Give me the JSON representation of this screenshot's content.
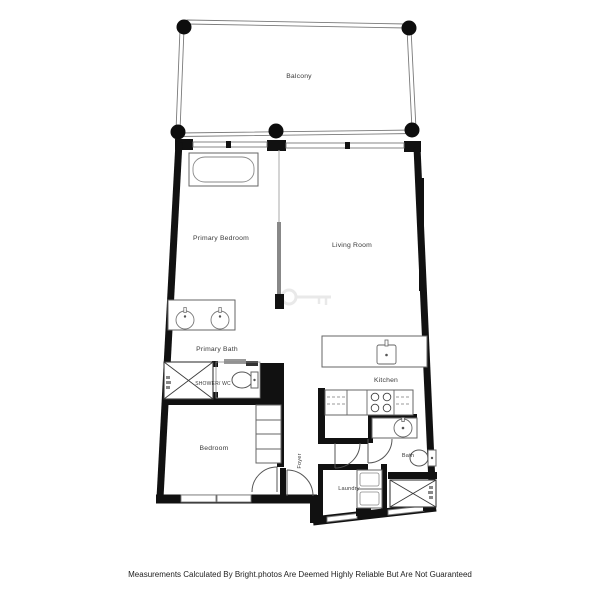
{
  "colors": {
    "background": "#ffffff",
    "wall": "#111111",
    "fixture_line": "#666666",
    "thin_line": "#7a7a7a",
    "label_text": "#3a3a3a",
    "footer_text": "#222222",
    "watermark": "#d8d8d8"
  },
  "rooms": {
    "balcony": "Balcony",
    "primary_bedroom": "Primary Bedroom",
    "living_room": "Living Room",
    "primary_bath": "Primary Bath",
    "shower_wc": "SHOWER/ WC",
    "bedroom": "Bedroom",
    "foyer": "Foyer",
    "kitchen": "Kitchen",
    "bath": "Bath",
    "laundry": "Laundry"
  },
  "footer": {
    "disclaimer": "Measurements Calculated By Bright.photos Are Deemed Highly Reliable But Are Not Guaranteed"
  }
}
